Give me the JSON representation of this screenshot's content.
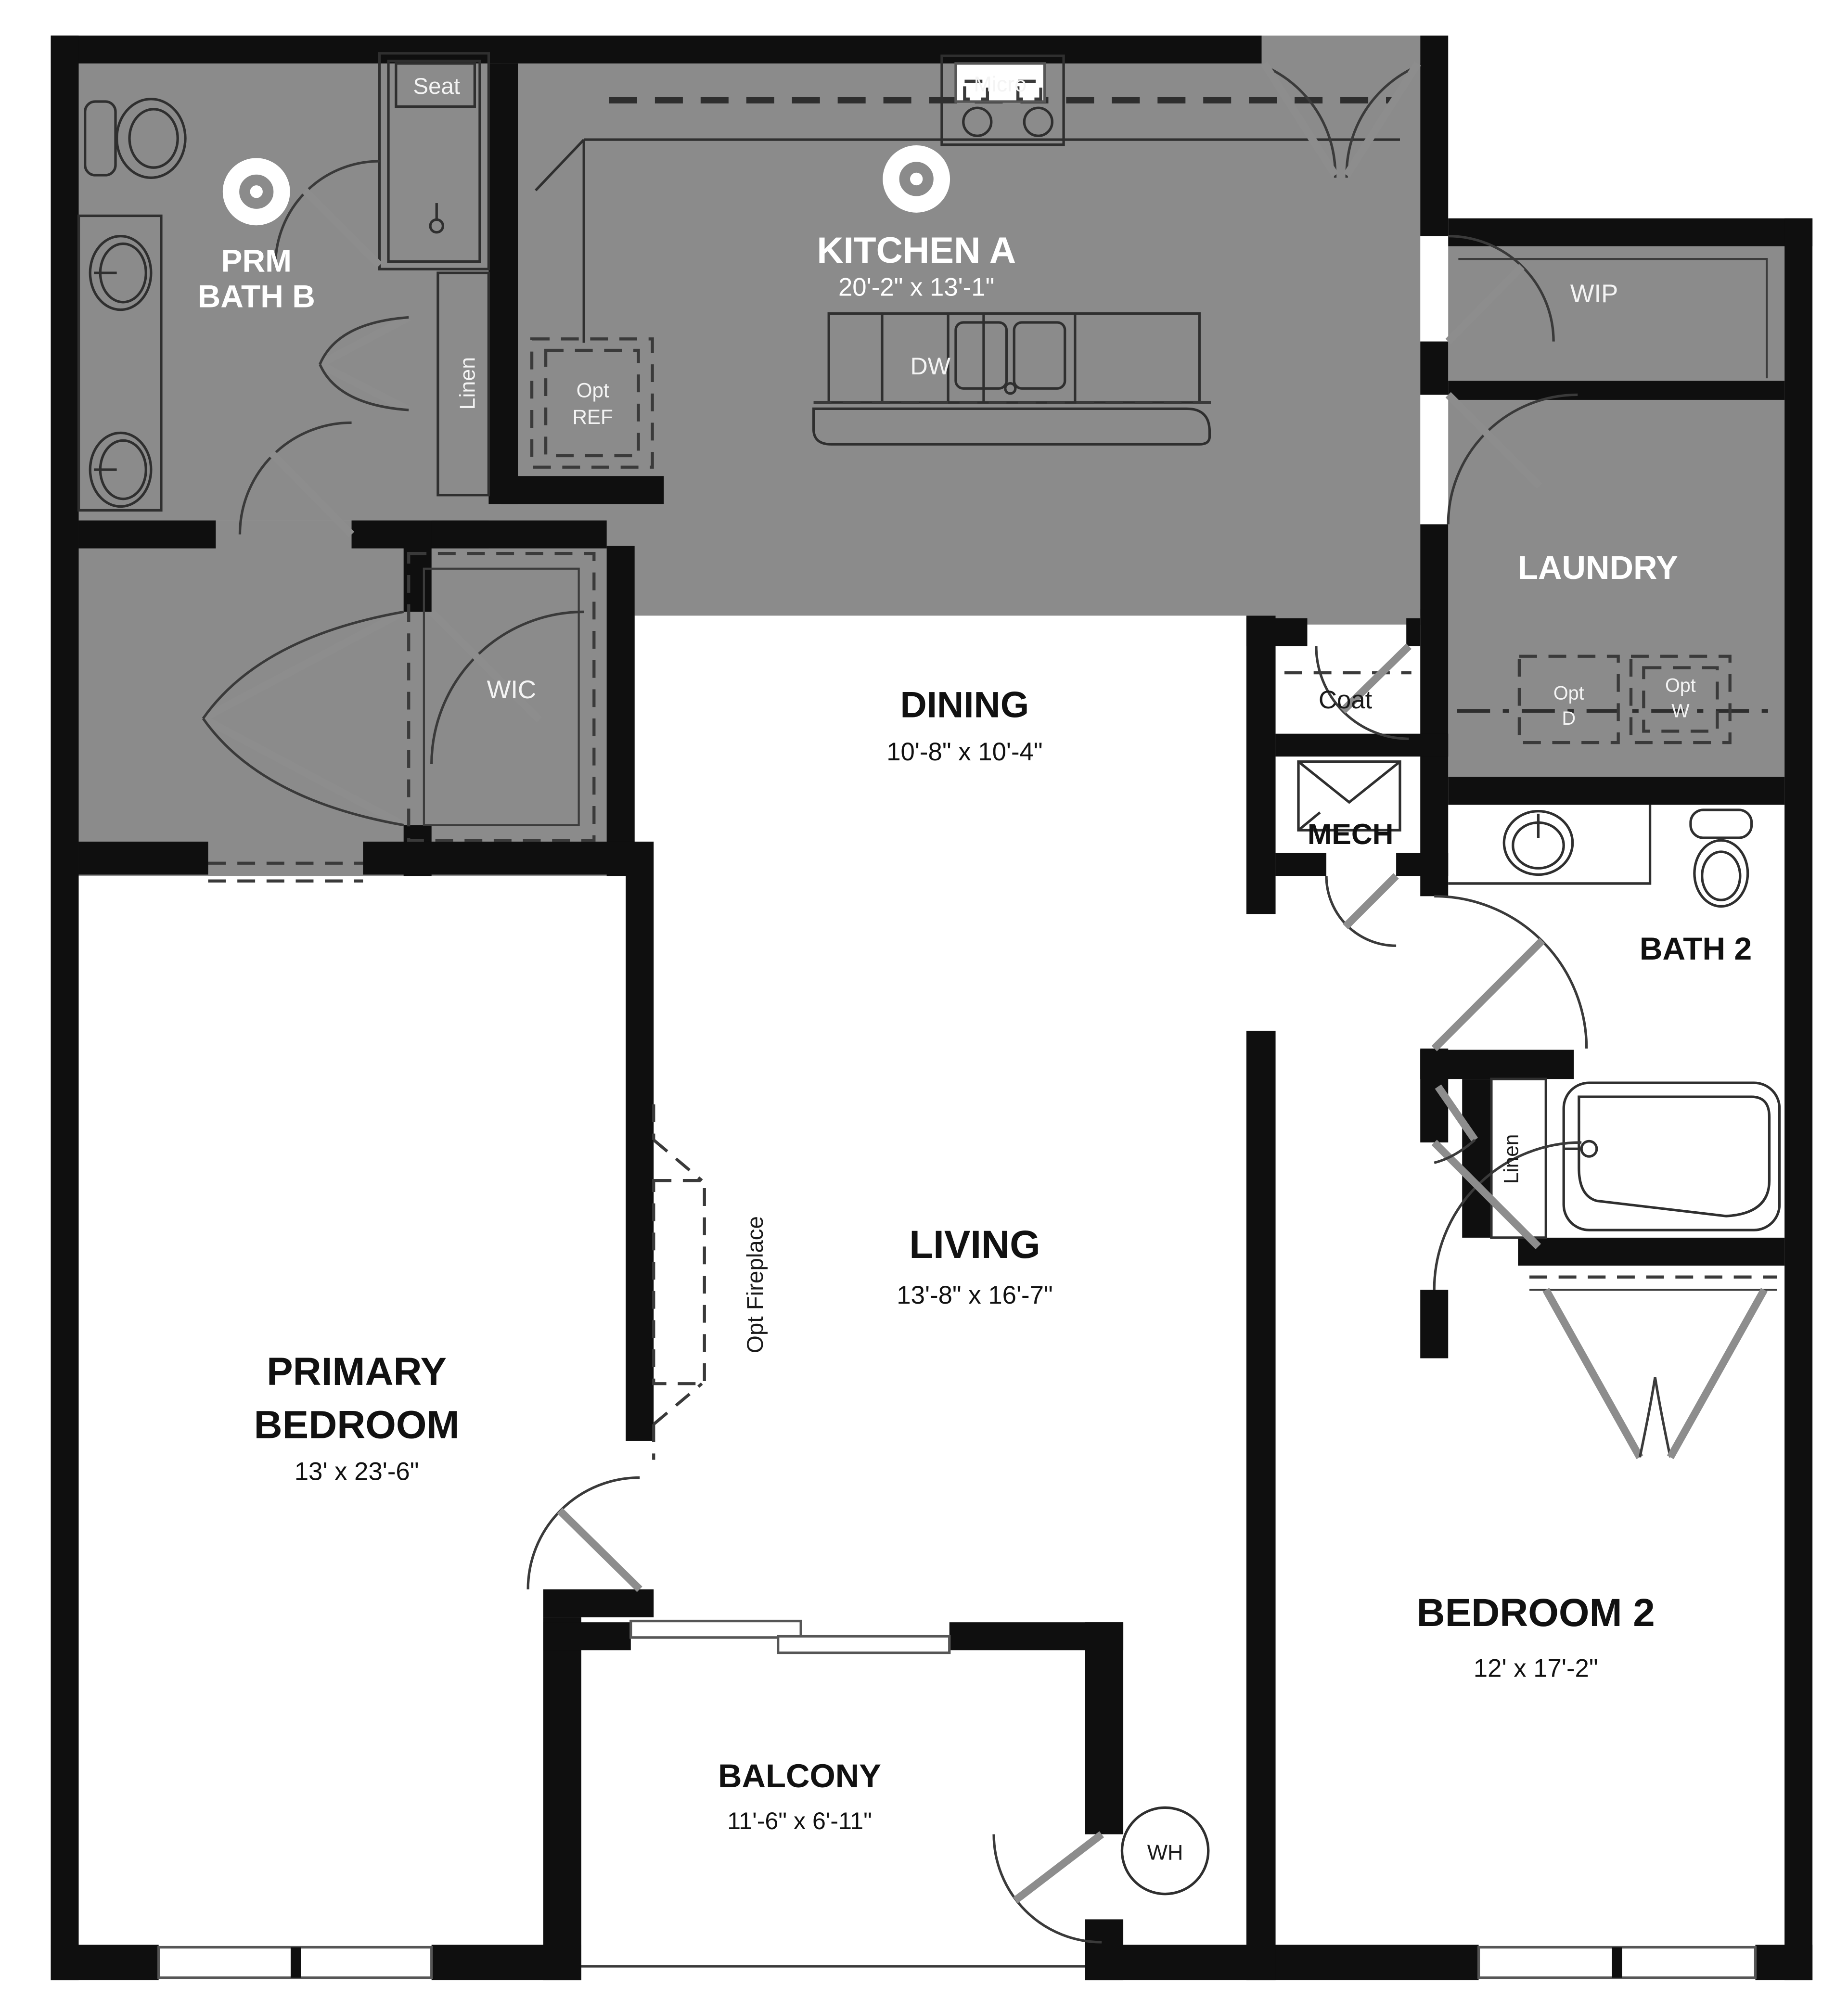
{
  "plan_title": "Two-bedroom apartment floor plan, Kitchen A option",
  "rooms": {
    "prm_bath": {
      "line1": "PRM",
      "line2": "BATH B"
    },
    "kitchen": {
      "name": "KITCHEN A",
      "dims": "20'-2\" x 13'-1\""
    },
    "dining": {
      "name": "DINING",
      "dims": "10'-8\" x 10'-4\""
    },
    "living": {
      "name": "LIVING",
      "dims": "13'-8\" x 16'-7\""
    },
    "primary": {
      "line1": "PRIMARY",
      "line2": "BEDROOM",
      "dims": "13' x 23'-6\""
    },
    "bedroom2": {
      "name": "BEDROOM 2",
      "dims": "12' x 17'-2\""
    },
    "balcony": {
      "name": "BALCONY",
      "dims": "11'-6\" x 6'-11\""
    },
    "laundry": {
      "name": "LAUNDRY"
    },
    "wip": {
      "name": "WIP"
    },
    "wic": {
      "name": "WIC"
    },
    "bath2": {
      "name": "BATH 2"
    },
    "mech": {
      "name": "MECH"
    },
    "coat": {
      "name": "Coat"
    }
  },
  "fixtures": {
    "seat": "Seat",
    "micro": "Micro",
    "dw": "DW",
    "opt_ref": {
      "line1": "Opt",
      "line2": "REF"
    },
    "linen_kitchen": "Linen",
    "linen_bath": "Linen",
    "opt_dryer": {
      "line1": "Opt",
      "line2": "D"
    },
    "opt_washer": {
      "line1": "Opt",
      "line2": "W"
    },
    "opt_fireplace": "Opt Fireplace",
    "water_heater": "WH"
  },
  "colors": {
    "wall": "#0f0f0f",
    "wet_area_gray": "#8b8b8b",
    "floor_white": "#ffffff",
    "fixture_line": "#2f2f2f"
  }
}
